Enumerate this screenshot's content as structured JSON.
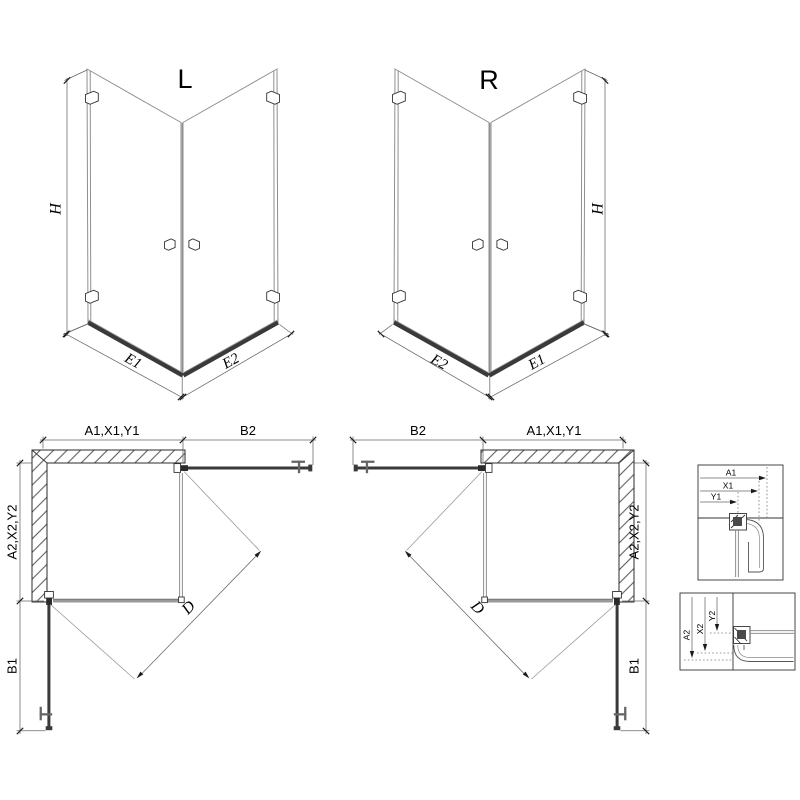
{
  "drawing": {
    "type": "corner shower enclosure technical drawing",
    "views": {
      "perspective_left": {
        "name": "L",
        "dims": {
          "height": "H",
          "left_edge": "E1",
          "right_edge": "E2"
        }
      },
      "perspective_right": {
        "name": "R",
        "dims": {
          "height": "H",
          "left_edge": "E2",
          "right_edge": "E1"
        }
      },
      "plan_left": {
        "dims": {
          "wall_top": "A1,X1,Y1",
          "door_top": "B2",
          "wall_side": "A2,X2,Y2",
          "door_side": "B1",
          "entry_diagonal": "D"
        }
      },
      "plan_right": {
        "dims": {
          "door_top": "B2",
          "wall_top": "A1,X1,Y1",
          "wall_side": "A2,X2,Y2",
          "door_side": "B1",
          "entry_diagonal": "D"
        }
      },
      "detail_wall_profile_top": {
        "dims": [
          "A1",
          "X1",
          "Y1"
        ]
      },
      "detail_wall_profile_side": {
        "dims": [
          "A2",
          "X2",
          "Y2"
        ]
      }
    },
    "colors": {
      "ink": "#1a1a1a",
      "glass": "#8f8f8f",
      "profile": "#3a3a3a",
      "dimension": "#666666",
      "background": "#ffffff"
    }
  }
}
